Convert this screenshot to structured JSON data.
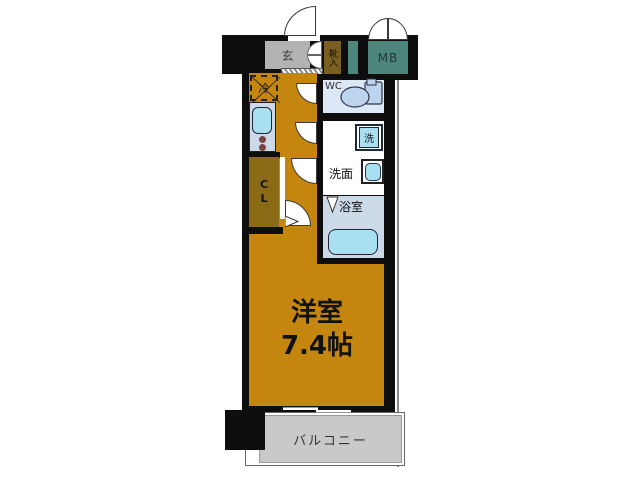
{
  "rooms": {
    "genkan": {
      "label": "玄"
    },
    "shoe_box": {
      "label": "靴入"
    },
    "meter_box": {
      "label": "MB"
    },
    "fridge": {
      "label": "冷"
    },
    "wc": {
      "label": "WC"
    },
    "washer": {
      "label": "洗"
    },
    "vanity": {
      "label": "洗面"
    },
    "bath": {
      "label": "浴室"
    },
    "closet": {
      "line1": "C",
      "line2": "L"
    },
    "main_room": {
      "name": "洋室",
      "size": "7.4帖"
    },
    "balcony": {
      "label": "バルコニー"
    }
  },
  "colors": {
    "wall": "#0e0e0e",
    "orange": "#c5860f",
    "olive": "#8a6a15",
    "olive2": "#7a6020",
    "genkan": "#b3b3b3",
    "teal": "#4d877c",
    "balcony": "#c9c9c9",
    "roomblue": "#dce8f6",
    "bathgray": "#ccd9e9",
    "cyan": "#a8e0f2",
    "toilet": "#bcd4ee",
    "line": "#888888"
  }
}
